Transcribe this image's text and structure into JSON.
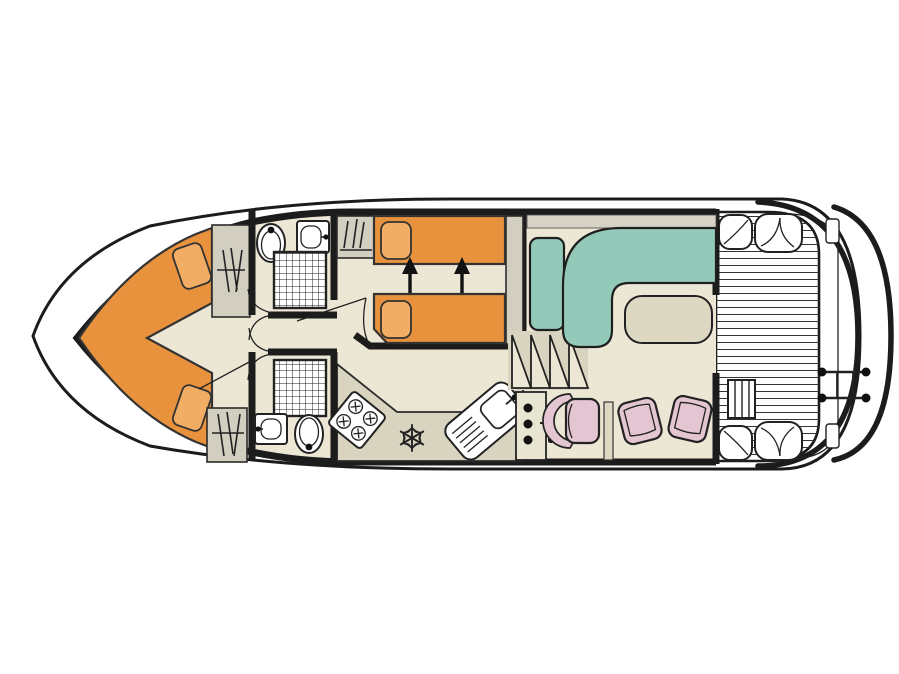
{
  "diagram": {
    "type": "houseboat-deck-plan-top-view",
    "title": "Boat floor plan",
    "palette": {
      "line": "#1c1c1c",
      "ink": "#2a2a2a",
      "floor": "#ece7d5",
      "galley": "#d8d4c0",
      "wardrobe": "#d2cfc1",
      "berth": "#e8923e",
      "pillow": "#f2ad65",
      "sofa": "#93c9b8",
      "seat": "#e3c6d2",
      "table": "#dcd8c2",
      "shelf": "#d6d3c6",
      "console": "#e9e5d3",
      "white": "#ffffff"
    },
    "rooms": [
      {
        "name": "bow-cabin",
        "features": [
          "v-shaped-double-berth",
          "two-pillows",
          "wardrobe-top",
          "wardrobe-bottom"
        ]
      },
      {
        "name": "bathroom-forward",
        "features": [
          "toilet",
          "washbasin",
          "shower"
        ]
      },
      {
        "name": "bathroom-aft",
        "features": [
          "shower",
          "washbasin",
          "toilet"
        ]
      },
      {
        "name": "mid-cabin",
        "features": [
          "single-berth-top",
          "single-berth-bottom",
          "slide-together-arrows",
          "wardrobe",
          "bedside-shelf"
        ]
      },
      {
        "name": "galley",
        "features": [
          "four-burner-stove",
          "fridge-snowflake",
          "sink-with-drainer"
        ]
      },
      {
        "name": "helm",
        "features": [
          "console-with-controls",
          "steering-wheel",
          "helm-seat"
        ]
      },
      {
        "name": "saloon",
        "features": [
          "l-shaped-sofa",
          "side-sofa",
          "table",
          "chair-left",
          "chair-right",
          "companionway-steps"
        ]
      },
      {
        "name": "aft-deck",
        "features": [
          "planked-floor",
          "four-corner-seats",
          "access-steps",
          "swim-ladder"
        ]
      }
    ],
    "icon_names": [
      "toilet-icon",
      "washbasin-icon",
      "shower-grid-icon",
      "hanger-icon",
      "stove-icon",
      "snowflake-icon",
      "sink-drainer-icon",
      "arrow-up-icon",
      "steps-zigzag-icon",
      "swim-ladder-icon"
    ],
    "counts": {
      "berths_bow": 1,
      "berths_mid": 2,
      "bathrooms": 2,
      "deck_corner_seats": 4
    }
  }
}
